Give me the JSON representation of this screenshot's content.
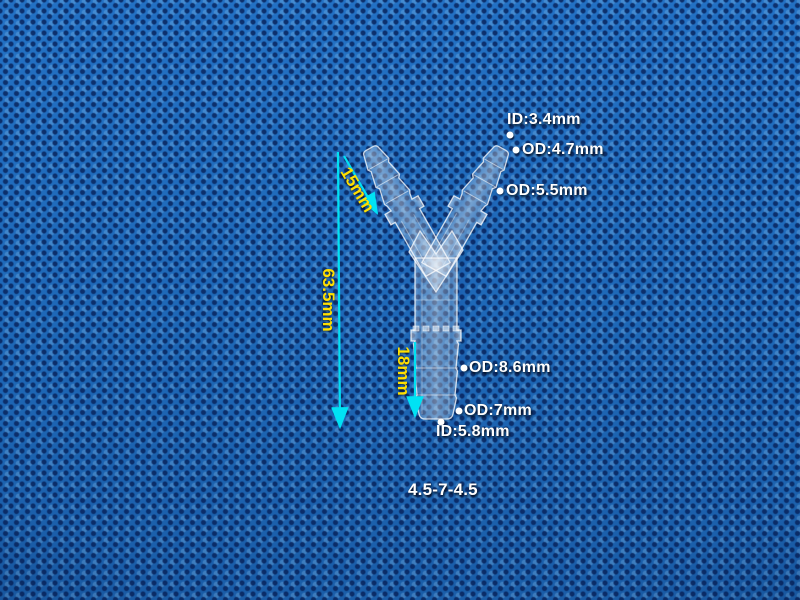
{
  "colors": {
    "background_blue": "#1e6ab9",
    "fabric_dot_navy": "#062058",
    "annotation_white": "#ffffff",
    "dimension_yellow": "#ffdf00",
    "arrow_cyan": "#00e2f4"
  },
  "measurements": {
    "top_ports": [
      {
        "label": "ID:3.4mm"
      },
      {
        "label": "OD:4.7mm"
      },
      {
        "label": "OD:5.5mm"
      }
    ],
    "bottom_port": [
      {
        "label": "OD:8.6mm"
      },
      {
        "label": "OD:7mm"
      },
      {
        "label": "ID:5.8mm"
      }
    ],
    "dimensions": {
      "arm_length": "15mm",
      "overall_height": "63.5mm",
      "stem_length": "18mm"
    },
    "size_code": "4.5-7-4.5"
  }
}
